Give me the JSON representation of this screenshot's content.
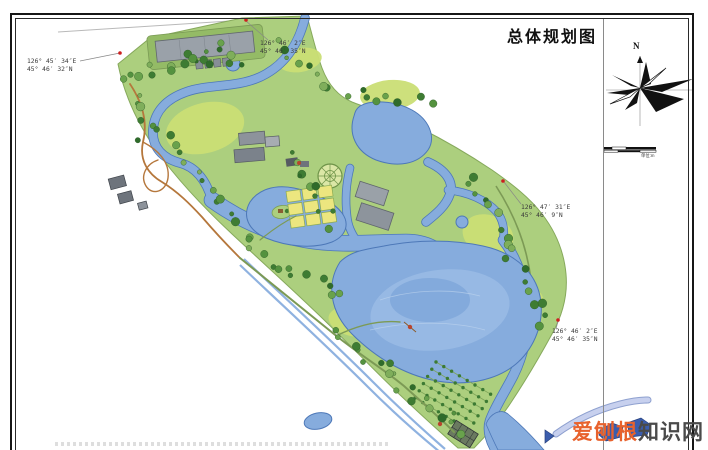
{
  "title_block": {
    "title": "总体规划图"
  },
  "compass": {
    "north_label": "N"
  },
  "scale_bar": {
    "unit_label": "单位:m"
  },
  "coordinate_labels": [
    {
      "line1": "126° 45′ 34″E",
      "line2": "45° 46′ 32″N"
    },
    {
      "line1": "126° 46′ 2″E",
      "line2": "45° 46′ 35″N"
    },
    {
      "line1": "126° 47′ 31″E",
      "line2": "45° 46′ 9″N"
    },
    {
      "line1": "126° 46′ 2″E",
      "line2": "45° 46′ 35″N"
    }
  ],
  "watermark": {
    "part1": "爱刨根",
    "part2": "知识网"
  },
  "palette": {
    "park_green": "#accf7e",
    "park_edge": "#86a95c",
    "lawn_green": "#cbdf75",
    "water_blue": "#86acdd",
    "water_edge": "#4d78b8",
    "water_deep": "#6f9cd4",
    "tree_green": "#3e7c33",
    "building_gray": "#9aa1a9",
    "building_dark": "#6e747c",
    "path_orange": "#b5773c",
    "path_green": "#7c9a55",
    "plot_yellow": "#ece67f",
    "survey_red": "#cc2020",
    "wm_orange": "#e8622d",
    "wm_gray": "#4a4a4a"
  }
}
